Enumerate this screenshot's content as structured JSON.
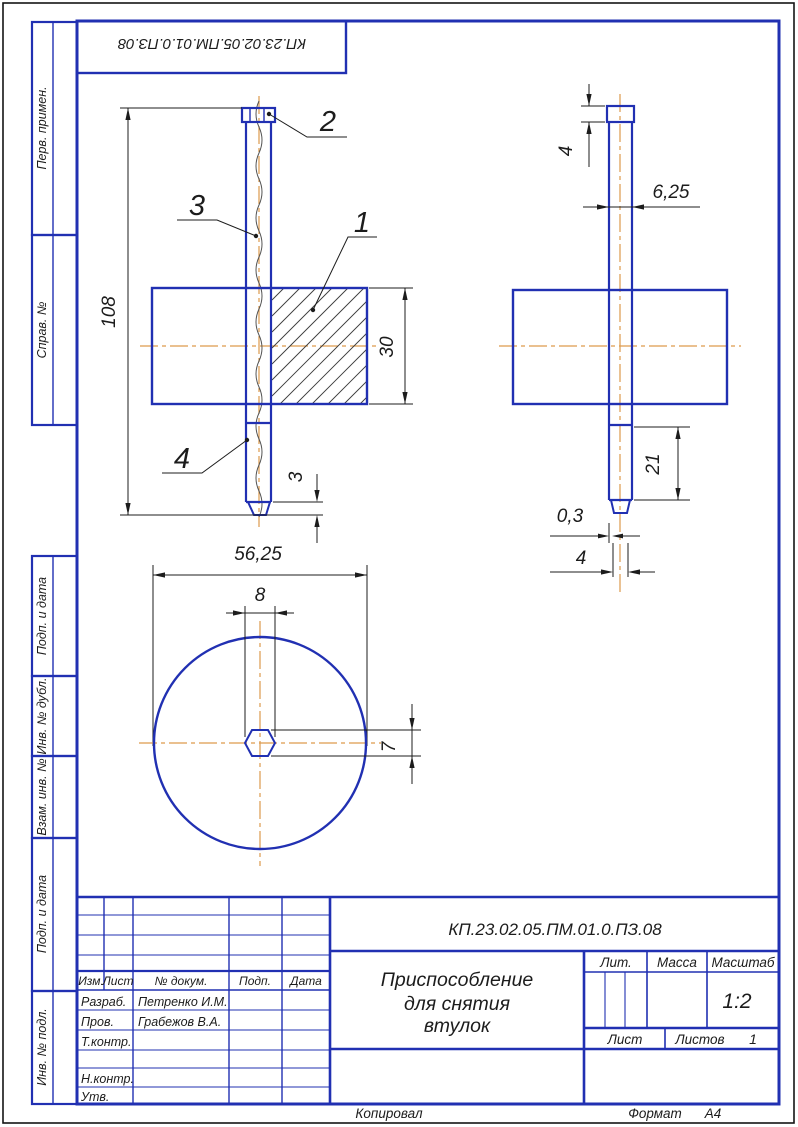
{
  "stamp": {
    "designation": "КП.23.02.05.ПМ.01.0.ПЗ.08"
  },
  "margin": {
    "cell1": "Перв. примен.",
    "cell2": "Справ. №",
    "cell3": "Подп. и дата",
    "cell4": "Инв. № дубл.",
    "cell5": "Взам. инв. №",
    "cell6": "Подп. и дата",
    "cell7": "Инв. № подл."
  },
  "views": {
    "front": {
      "dim_height": "108",
      "dim_body": "30",
      "dim_tip": "3",
      "dim_diameter": "56,25",
      "callout_1": "1",
      "callout_2": "2",
      "callout_3": "3",
      "callout_4": "4"
    },
    "side": {
      "dim_head": "4",
      "dim_rod": "6,25",
      "dim_tip_len": "21",
      "dim_wall": "0,3",
      "dim_tip_w": "4"
    },
    "bottom": {
      "dim_hex_w": "8",
      "dim_hex_h": "7"
    }
  },
  "titleblock": {
    "designation": "КП.23.02.05.ПМ.01.0.ПЗ.08",
    "title_line1": "Приспособление",
    "title_line2": "для снятия",
    "title_line3": "втулок",
    "lit_label": "Лит.",
    "mass_label": "Масса",
    "scale_label": "Масштаб",
    "scale_value": "1:2",
    "sheet_label": "Лист",
    "sheets_label": "Листов",
    "sheets_value": "1",
    "col_izm": "Изм.",
    "col_list": "Лист",
    "col_doc": "№ докум.",
    "col_sign": "Подп.",
    "col_date": "Дата",
    "row_razrab": "Разраб.",
    "row_razrab_name": "Петренко И.М.",
    "row_prov": "Пров.",
    "row_prov_name": "Грабежов В.А.",
    "row_tkontr": "Т.контр.",
    "row_nkontr": "Н.контр.",
    "row_utv": "Утв."
  },
  "footer": {
    "copied": "Копировал",
    "format_label": "Формат",
    "format_value": "А4"
  }
}
